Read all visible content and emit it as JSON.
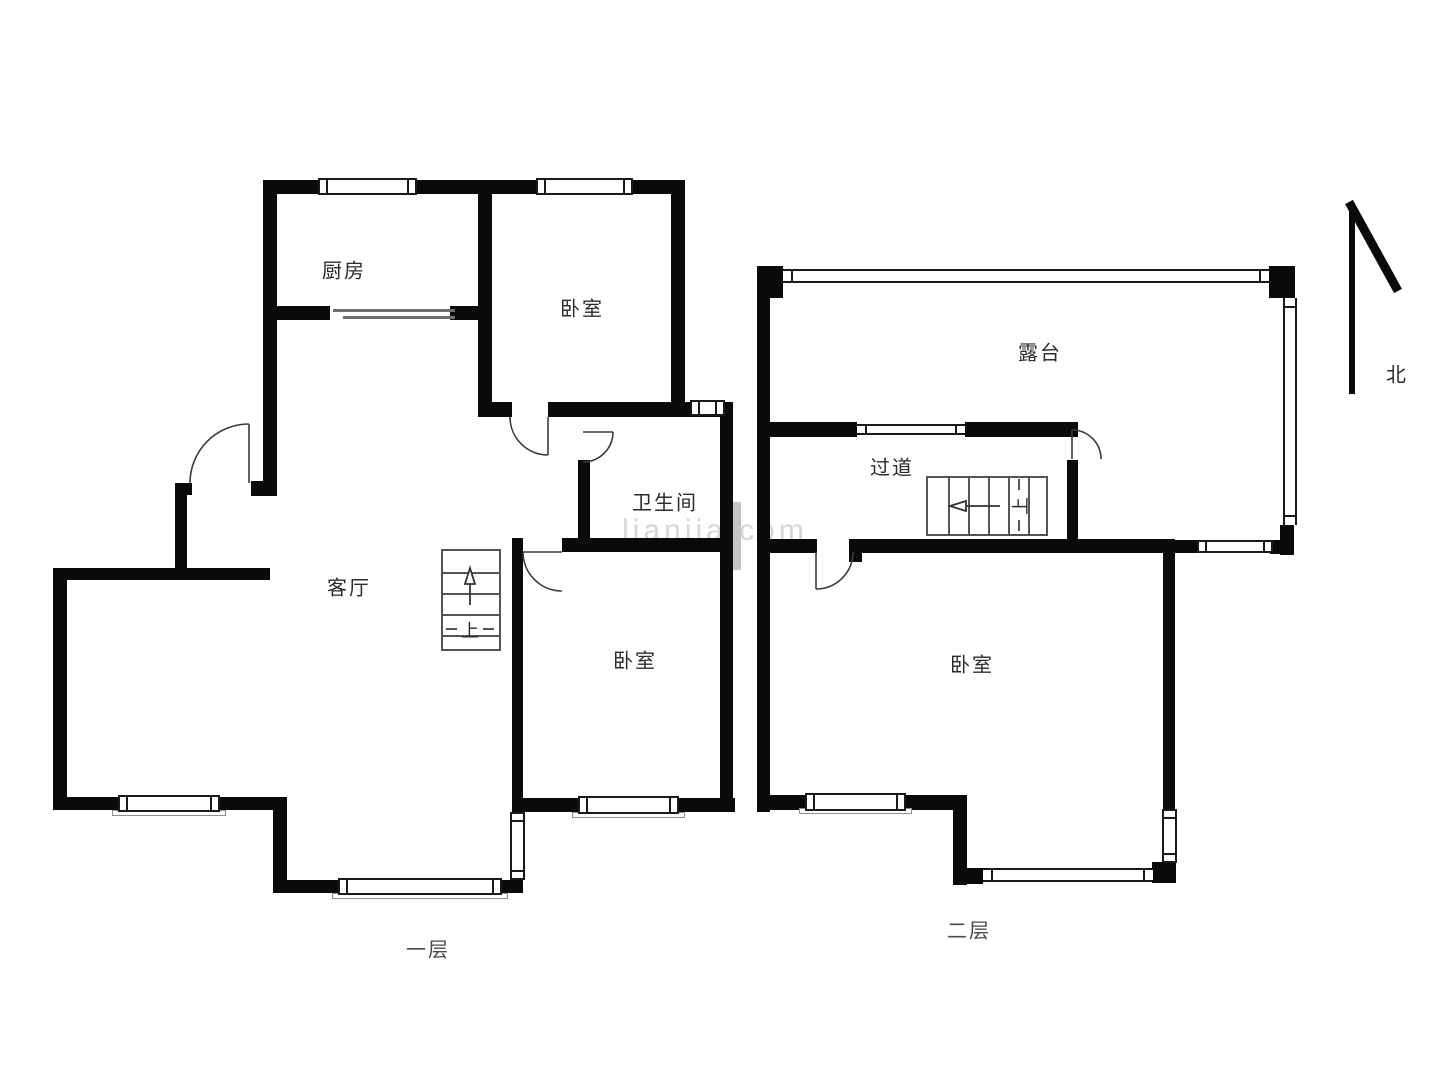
{
  "floor1": {
    "caption": "一层",
    "kitchen": "厨房",
    "bedroom_top": "卧室",
    "bathroom": "卫生间",
    "living_room": "客厅",
    "bedroom_bottom": "卧室",
    "stairs_up": "上"
  },
  "floor2": {
    "caption": "二层",
    "terrace": "露台",
    "corridor": "过道",
    "bedroom": "卧室",
    "stairs_up": "上"
  },
  "compass": {
    "north": "北"
  },
  "watermark": "lianjia.com",
  "colors": {
    "wall": "#0a0a0a",
    "door": "#3a3a3a",
    "stair": "#555555",
    "label": "#2b2b2b",
    "caption": "#4a4a4a",
    "sill": "#8f8f8f"
  }
}
